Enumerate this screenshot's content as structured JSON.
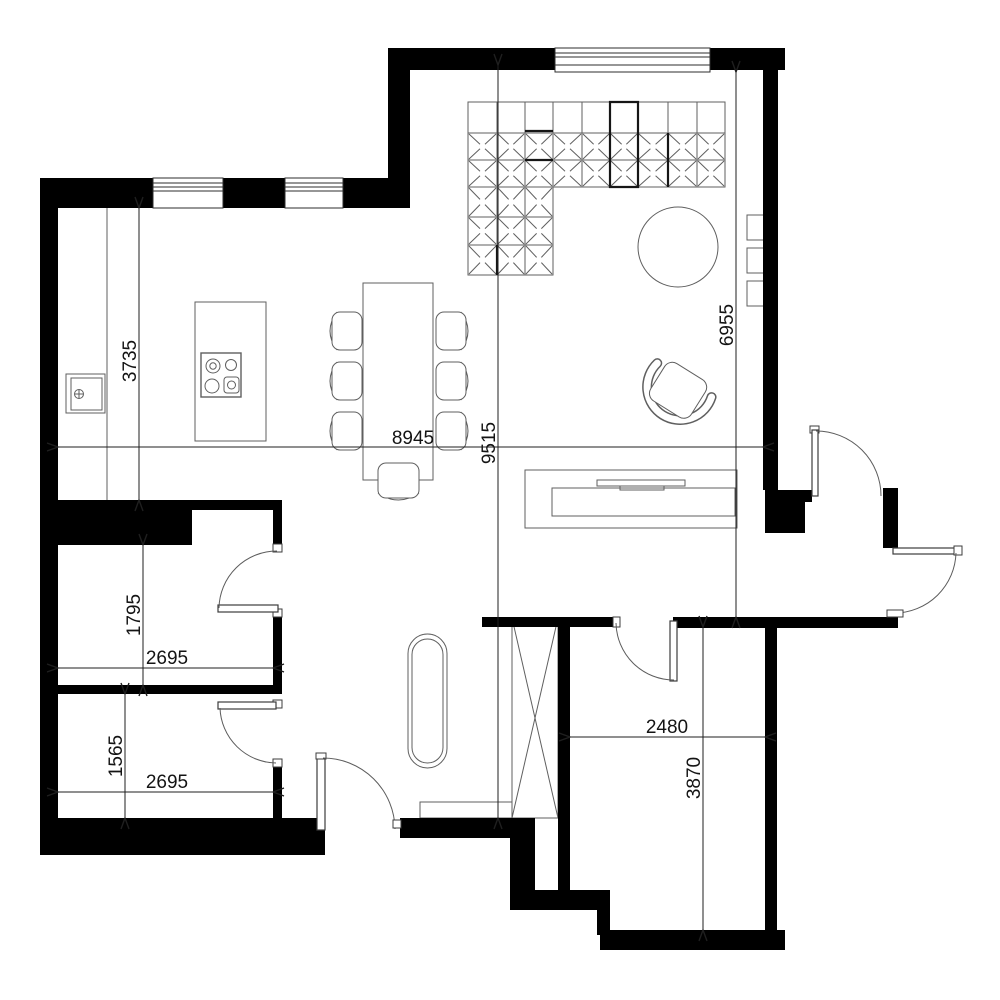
{
  "colors": {
    "background": "#ffffff",
    "wall": "#000000",
    "furniture_line": "#5f5f5f",
    "dimension": "#1f1f1f"
  },
  "dimensions": {
    "kitchen_depth": "3735",
    "living_width": "8945",
    "overall_height": "9515",
    "living_height_right": "6955",
    "room1_height": "1795",
    "room1_width": "2695",
    "room2_height": "1565",
    "room2_width": "2695",
    "bottom_room_width": "2480",
    "bottom_room_height": "3870"
  }
}
